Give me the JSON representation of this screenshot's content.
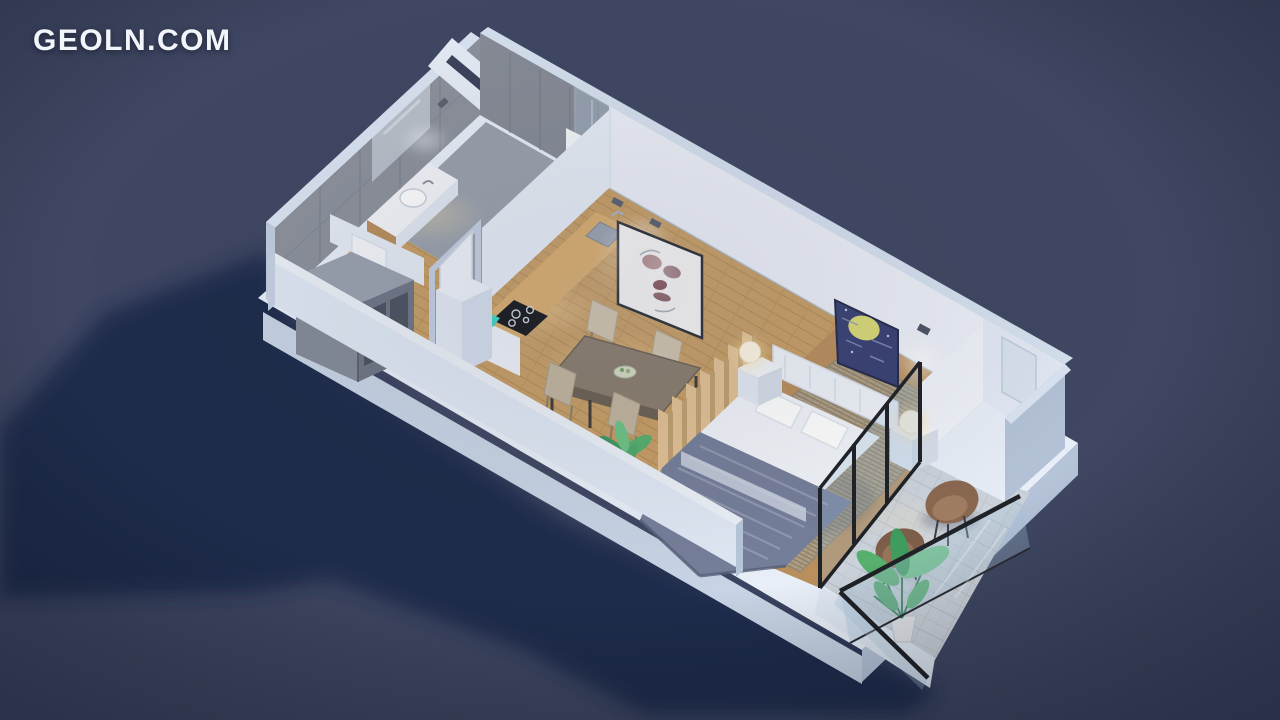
{
  "meta": {
    "title": "3D isometric cutaway render of a studio apartment floor plan, night scene"
  },
  "watermark": {
    "text": "GEOLN.COM"
  },
  "colors": {
    "background": "#3f4763",
    "shadow": "#1d2a4b",
    "wall_top": "#dae4f2",
    "wall_light": "#e9eff8",
    "wall_shade": "#b4c2d8",
    "slab_side": "#c8d4e5",
    "tile_wall": "#8d929d",
    "bathroom_floor": "#9aa1ac",
    "wood_floor": "#c79e66",
    "counter_wood": "#d9ad6e",
    "cooktop": "#17181c",
    "accent_teal": "#3fd4c6",
    "table": "#8a7d6d",
    "chair_beige": "#cfc3ac",
    "slat_wood": "#e2c294",
    "rug": "#b0a088",
    "bed_white": "#f1f4f9",
    "blanket": "#767f9a",
    "balcony_chair": "#8a6850",
    "plant": "#4fa96b",
    "glass": "#a9c4dc",
    "frame_dark": "#1f2227",
    "art_night": "#3a4274",
    "art_moon": "#d9d977",
    "lamp_glow": "#ffe2a8"
  },
  "scene": {
    "view": "isometric cutaway, camera from south-west, warm interior lighting",
    "rooms": [
      {
        "name": "Bathroom",
        "features": [
          "gray tiled walls",
          "wall mirror",
          "washbasin on vanity with wood shelf",
          "toilet",
          "walk-in shower with glass panel",
          "hanging white towel",
          "blue folded mat",
          "ceiling spotlights"
        ]
      },
      {
        "name": "Hallway",
        "features": [
          "open gray wardrobe with two sections",
          "wood floor",
          "open white interior door with light-blue frame"
        ]
      },
      {
        "name": "Kitchen",
        "features": [
          "wooden countertop",
          "black induction cooktop with four burners",
          "inset metal sink with faucet",
          "teal kettle accent",
          "tall white cabinet"
        ]
      },
      {
        "name": "Dining area",
        "features": [
          "dark rectangular dining table",
          "four beige chairs",
          "decorative bowl",
          "framed face-portrait artwork",
          "two ceiling spotlights",
          "potted green plant",
          "wood plank floor"
        ]
      },
      {
        "name": "Bedroom",
        "features": [
          "double bed with white bedding and headboard",
          "two pillows",
          "blue-gray striped throw blanket",
          "two white nightstands",
          "two glowing globe lamps",
          "textured area rug",
          "night-sky artwork with yellow moon",
          "wall spotlights",
          "wooden slat partition"
        ]
      },
      {
        "name": "Entry nook",
        "features": [
          "bright white walls",
          "recessed entrance door"
        ]
      },
      {
        "name": "Balcony",
        "features": [
          "black framed glass doors",
          "frameless glass balustrade with dark handrail",
          "two brown lounge chairs",
          "tall potted plant",
          "stone tile floor"
        ]
      }
    ]
  }
}
